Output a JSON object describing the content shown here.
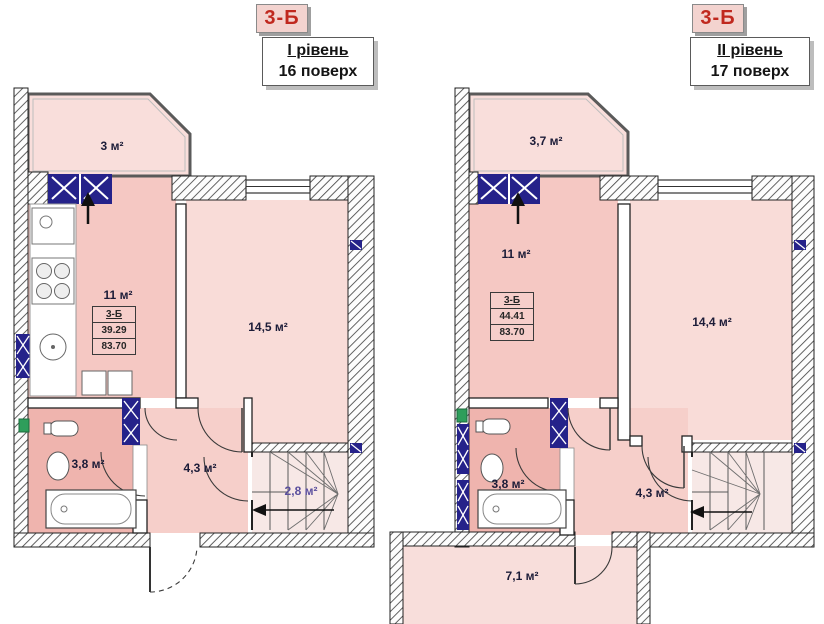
{
  "colors": {
    "accent_red": "#c0281e",
    "window_navy": "#25228a",
    "room_pink": "#f9dcd8",
    "kitchen_pink": "#f5c8c3",
    "wet_pink": "#efb4ae",
    "hall_pink": "#f6cfca"
  },
  "icons": {
    "balcony_door_arrow": "↑",
    "stairs_direction_arrow": "←"
  },
  "header_left": {
    "unit": "3-Б",
    "level": "І рівень",
    "floor": "16 поверх"
  },
  "header_right": {
    "unit": "3-Б",
    "level": "ІІ рівень",
    "floor": "17 поверх"
  },
  "plan_left": {
    "rooms": {
      "balcony": "3 м²",
      "kitchen": "11 м²",
      "living": "14,5 м²",
      "bathroom": "3,8 м²",
      "hall": "4,3 м²",
      "stairs": "2,8 м²"
    },
    "info": {
      "unit": "3-Б",
      "living_area": "39.29",
      "total_area": "83.70"
    }
  },
  "plan_right": {
    "rooms": {
      "balcony": "3,7 м²",
      "living": "11 м²",
      "bedroom": "14,4 м²",
      "bathroom": "3,8 м²",
      "hall": "4,3 м²",
      "lower_room": "7,1 м²"
    },
    "info": {
      "unit": "3-Б",
      "living_area": "44.41",
      "total_area": "83.70"
    }
  }
}
